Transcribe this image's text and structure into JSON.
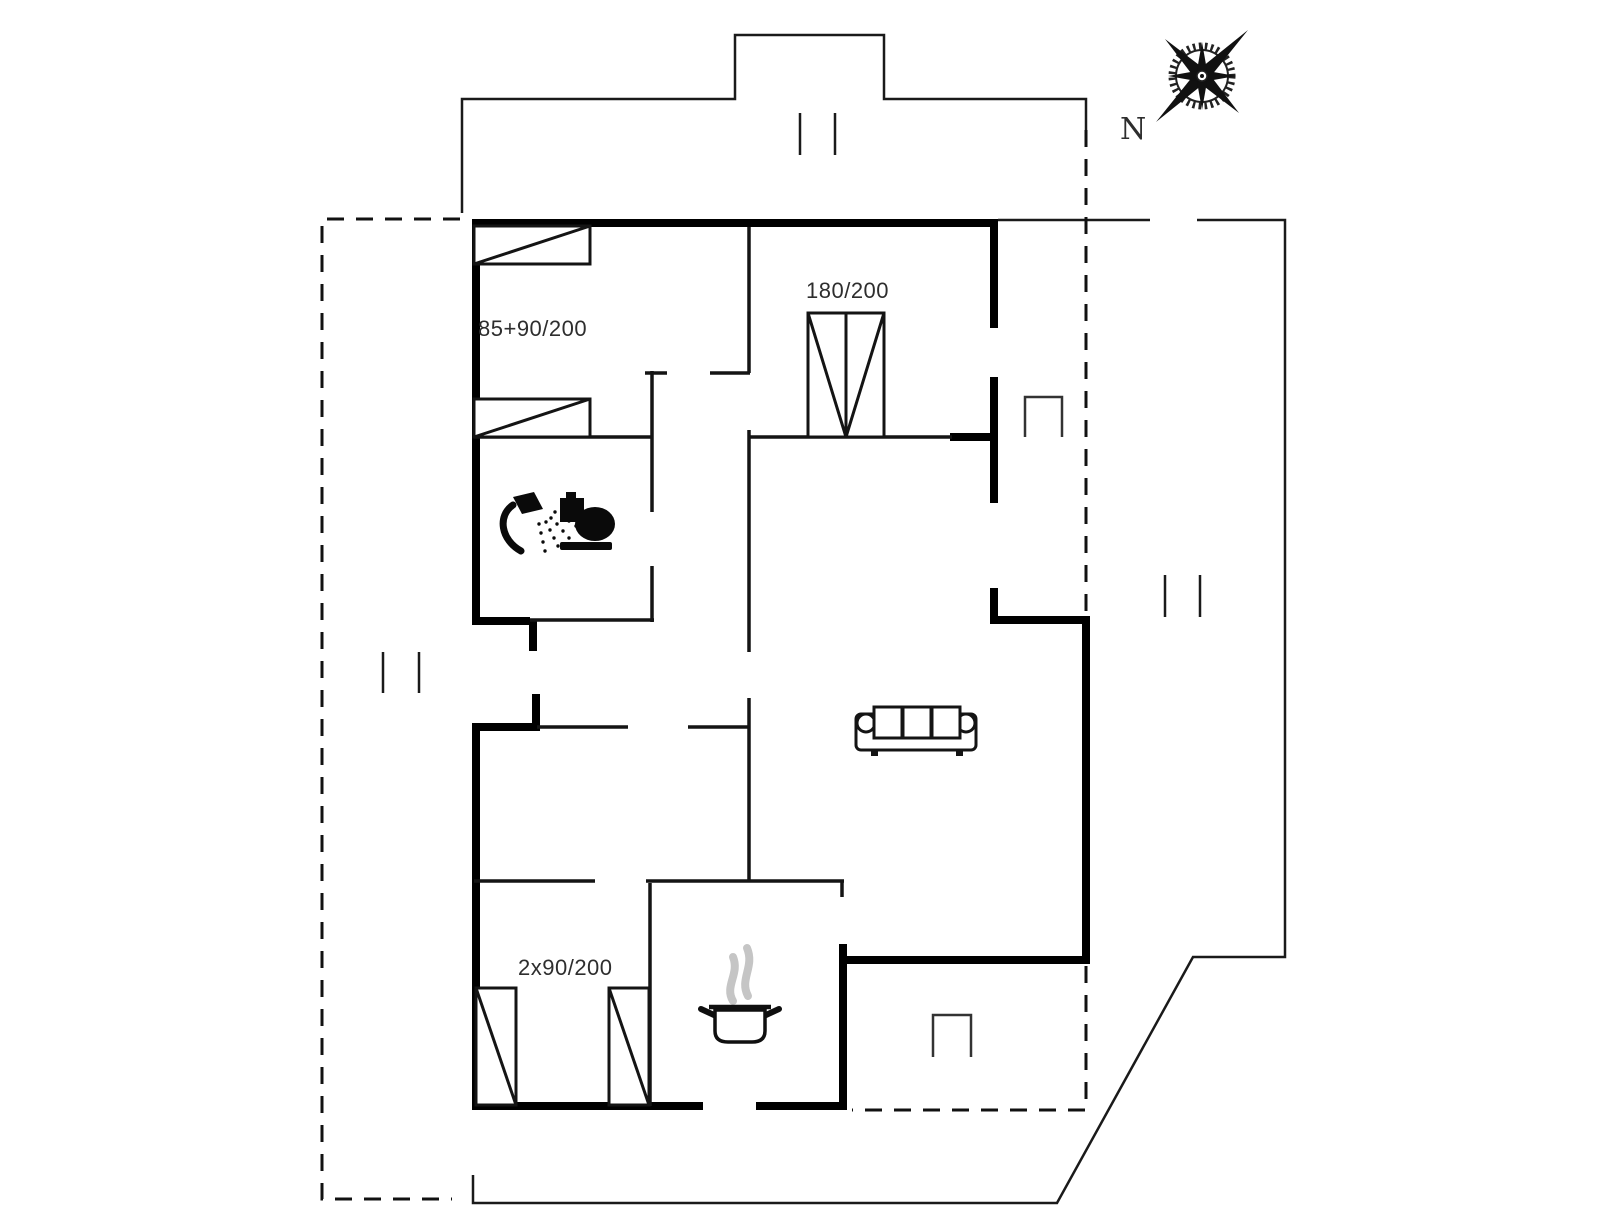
{
  "floorplan": {
    "type": "holiday-home-floor-plan",
    "compass": {
      "north_label": "N"
    },
    "labels": {
      "bedroom_left_beds": "85+90/200",
      "bedroom_right_bed": "180/200",
      "bedroom_lower_beds": "2x90/200"
    },
    "colors": {
      "exterior_wall": "#000000",
      "interior_wall": "#141414",
      "thin_outline": "#1a1a1a",
      "dashed_terrace": "#111111",
      "label_text": "#2e2e2e",
      "steam": "#c5c5c5",
      "background": "#ffffff"
    },
    "icons": [
      "compass-rose-icon",
      "shower-icon",
      "toilet-icon",
      "sofa-icon",
      "stove-pot-icon",
      "single-bed-icon",
      "double-bed-icon",
      "window-marker-icon",
      "door-step-marker-icon"
    ]
  }
}
